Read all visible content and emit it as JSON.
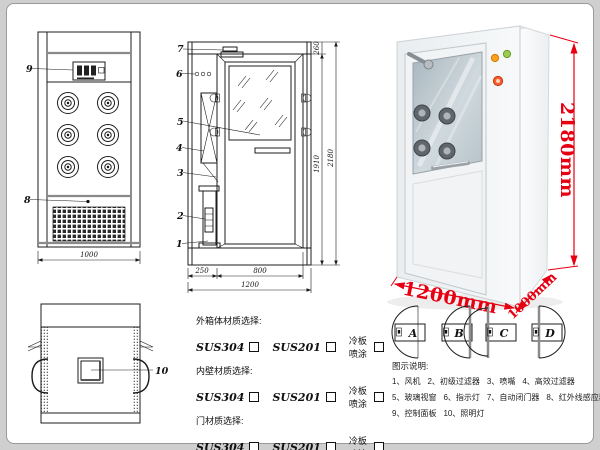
{
  "parts": [
    "1",
    "2",
    "3",
    "4",
    "5",
    "6",
    "7",
    "8",
    "9",
    "10"
  ],
  "dims": {
    "front_width": "1000",
    "side_left": "250",
    "side_door": "800",
    "side_total": "1200",
    "height_inner": "1910",
    "height_total": "2180",
    "height_top": "260"
  },
  "photo": {
    "height": "2180mm",
    "width": "1200mm",
    "depth": "1000mm"
  },
  "door_options": {
    "letters": [
      "A",
      "B",
      "C",
      "D"
    ]
  },
  "materials": {
    "groups": [
      {
        "title": "外箱体材质选择:",
        "options": [
          "SUS304",
          "SUS201",
          "冷板喷涂"
        ]
      },
      {
        "title": "内壁材质选择:",
        "options": [
          "SUS304",
          "SUS201",
          "冷板喷涂"
        ]
      },
      {
        "title": "门材质选择:",
        "options": [
          "SUS304",
          "SUS201",
          "冷板喷涂"
        ]
      }
    ]
  },
  "legend": {
    "title": "图示说明:",
    "items": [
      "1、风机",
      "2、初级过滤器",
      "3、喷嘴",
      "4、高效过滤器",
      "5、玻璃视窗",
      "6、指示灯",
      "7、自动闭门器",
      "8、红外线感应器",
      "9、控制面板",
      "10、照明灯"
    ]
  },
  "colors": {
    "dimension_red": "#e60012",
    "line": "#1c1c1c"
  }
}
